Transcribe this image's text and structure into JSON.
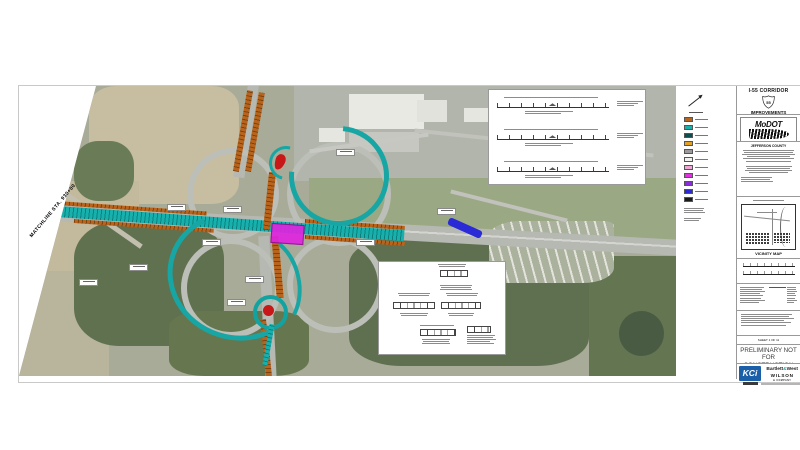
{
  "sheet": {
    "matchline_label": "MATCHLINE STA. 930+00",
    "aerial": {
      "overlay_colors": {
        "proposed_alignment_teal": "#17b0ad",
        "ramp_corridor_orange": "#b9641c",
        "bridge_magenta": "#df25df",
        "island_red": "#c81717",
        "marker_blue": "#2a2ad6"
      }
    },
    "legend": {
      "swatches": [
        {
          "color": "#b9641c"
        },
        {
          "color": "#17b0ad"
        },
        {
          "color": "#0d4f4e"
        },
        {
          "color": "#e3a11f"
        },
        {
          "color": "#9b9b9b"
        },
        {
          "color": "#f2f2ef"
        },
        {
          "color": "#f2a6d8"
        },
        {
          "color": "#e030e0"
        },
        {
          "color": "#8a2be2"
        },
        {
          "color": "#2a2ad6"
        },
        {
          "color": "#1a1a1a"
        }
      ]
    },
    "title_block": {
      "project_line1": "I-55 CORRIDOR",
      "shield_number": "55",
      "project_line2": "IMPROVEMENTS",
      "agency": "MoDOT",
      "county": "JEFFERSON COUNTY",
      "vicinity_label": "VICINITY MAP",
      "sheet_label": "SHEET 1 OF 11",
      "status_line1": "PRELIMINARY NOT",
      "status_line2": "FOR CONSTRUCTION",
      "firms": {
        "kci": "KCi",
        "bartlett": "Bartlett",
        "ampersand": "&",
        "west": "West",
        "wilson": "WILSON",
        "wilson_tagline": "& COMPANY"
      }
    }
  }
}
